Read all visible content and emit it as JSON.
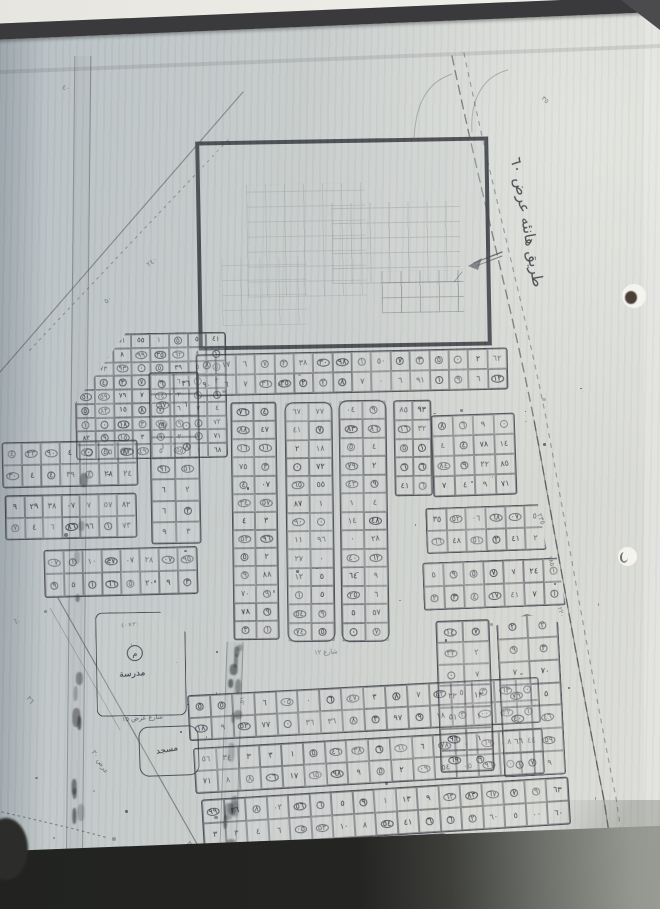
{
  "photo": {
    "paper_color": "#c6cbc9",
    "ink_color": "#3c3e46",
    "page_edge_bar_color": "#3a3a3c",
    "backing_top_color": "#efeee9",
    "backing_bottom_color": "#242523"
  },
  "labels": {
    "road_top_right": "طريق هانئه عرض ٦٠",
    "school": "مدرسة",
    "school_symbol": "م",
    "mosque": "مسجد",
    "street_south_of_school": "شارع عرض ١٥"
  },
  "map": {
    "glyph_pool": [
      "٠",
      "١",
      "٢",
      "٣",
      "٤",
      "٥",
      "٦",
      "٧",
      "٨",
      "٩"
    ],
    "blocks": [
      {
        "id": "triangle-block",
        "x": 75,
        "y": 333,
        "w": 152,
        "h": 126,
        "rows": 9,
        "cols": 8,
        "rot": -1,
        "r": 4,
        "clip": "polygon(34% 0, 100% 0, 100% 100%, 0 100%, 0 55%)"
      },
      {
        "id": "strip-under-rect",
        "x": 196,
        "y": 351,
        "w": 312,
        "h": 42,
        "rows": 2,
        "cols": 16,
        "rot": -1.3,
        "r": 3
      },
      {
        "id": "v-strip-1",
        "x": 232,
        "y": 402,
        "w": 46,
        "h": 238,
        "rows": 13,
        "cols": 2,
        "rot": -0.8,
        "r": 3
      },
      {
        "id": "v-strip-2",
        "x": 286,
        "y": 402,
        "w": 48,
        "h": 240,
        "rows": 13,
        "cols": 2,
        "rot": -0.8,
        "r": 9
      },
      {
        "id": "v-strip-3",
        "x": 340,
        "y": 400,
        "w": 48,
        "h": 242,
        "rows": 13,
        "cols": 2,
        "rot": -0.8,
        "r": 9
      },
      {
        "id": "v-strip-4",
        "x": 394,
        "y": 400,
        "w": 38,
        "h": 96,
        "rows": 5,
        "cols": 2,
        "rot": -1,
        "r": 3
      },
      {
        "id": "right-block-top",
        "x": 432,
        "y": 414,
        "w": 84,
        "h": 82,
        "rows": 4,
        "cols": 4,
        "rot": -2,
        "r": 3
      },
      {
        "id": "right-strip-1",
        "x": 426,
        "y": 506,
        "w": 120,
        "h": 46,
        "rows": 2,
        "cols": 6,
        "rot": -2,
        "r": 3,
        "clip": "polygon(0 0, 94% 0, 100% 100%, 0 100%)"
      },
      {
        "id": "right-strip-2",
        "x": 423,
        "y": 560,
        "w": 142,
        "h": 48,
        "rows": 2,
        "cols": 7,
        "rot": -2.2,
        "r": 3,
        "clip": "polygon(0 0, 95% 0, 100% 100%, 0 100%)"
      },
      {
        "id": "left-column",
        "x": 150,
        "y": 372,
        "w": 50,
        "h": 172,
        "rows": 8,
        "cols": 2,
        "rot": -1,
        "r": 3
      },
      {
        "id": "left-strip-1",
        "x": 2,
        "y": 441,
        "w": 136,
        "h": 46,
        "rows": 2,
        "cols": 7,
        "rot": -1.2,
        "r": 3
      },
      {
        "id": "left-strip-2",
        "x": 5,
        "y": 494,
        "w": 132,
        "h": 45,
        "rows": 2,
        "cols": 7,
        "rot": -1.2,
        "r": 3
      },
      {
        "id": "left-strip-3",
        "x": 44,
        "y": 548,
        "w": 154,
        "h": 48,
        "rows": 2,
        "cols": 8,
        "rot": -1.5,
        "r": 3
      },
      {
        "id": "bottom-strip-1",
        "x": 188,
        "y": 686,
        "w": 352,
        "h": 46,
        "rows": 2,
        "cols": 16,
        "rot": -3,
        "r": 3
      },
      {
        "id": "bottom-strip-2",
        "x": 194,
        "y": 738,
        "w": 350,
        "h": 46,
        "rows": 2,
        "cols": 16,
        "rot": -3.3,
        "r": 3
      },
      {
        "id": "bottom-strip-3",
        "x": 202,
        "y": 788,
        "w": 368,
        "h": 48,
        "rows": 2,
        "cols": 17,
        "rot": -3.6,
        "r": 3
      },
      {
        "id": "bottom-strip-4",
        "x": 188,
        "y": 840,
        "w": 260,
        "h": 56,
        "rows": 2,
        "cols": 11,
        "rot": -3,
        "r": 3
      },
      {
        "id": "bottom-right-low",
        "x": 452,
        "y": 846,
        "w": 168,
        "h": 58,
        "rows": 2,
        "cols": 8,
        "rot": -4,
        "r": 4
      },
      {
        "id": "bottom-v-strip-1",
        "x": 438,
        "y": 620,
        "w": 54,
        "h": 152,
        "rows": 7,
        "cols": 2,
        "rot": -2,
        "r": 3
      },
      {
        "id": "bottom-v-strip-2",
        "x": 500,
        "y": 614,
        "w": 62,
        "h": 162,
        "rows": 7,
        "cols": 2,
        "rot": -3,
        "r": 3,
        "clip": "polygon(0 6%, 50% 0, 100% 6%, 100% 100%, 0 100%)"
      }
    ],
    "notes": [
      {
        "t": "٢٣٥",
        "cx": 541,
        "cy": 519,
        "rot": 70,
        "s": 7,
        "o": 0.6
      },
      {
        "t": "١٨٥",
        "cx": 551,
        "cy": 561,
        "rot": 72,
        "s": 6.5,
        "o": 0.6
      },
      {
        "t": "٢٢٠",
        "cx": 561,
        "cy": 612,
        "rot": 74,
        "s": 6.5,
        "o": 0.55
      },
      {
        "t": "٢٤٠",
        "cx": 152,
        "cy": 262,
        "rot": -38,
        "s": 7,
        "o": 0.5
      },
      {
        "t": "٥٠",
        "cx": 108,
        "cy": 300,
        "rot": -38,
        "s": 7,
        "o": 0.5
      },
      {
        "t": "عرض ٢٠",
        "cx": 100,
        "cy": 762,
        "rot": 58,
        "s": 7,
        "o": 0.6
      },
      {
        "t": "٢٦",
        "cx": 30,
        "cy": 700,
        "rot": 55,
        "s": 7,
        "o": 0.55
      },
      {
        "t": "٤٠",
        "cx": 66,
        "cy": 88,
        "rot": 8,
        "s": 7,
        "o": 0.5
      },
      {
        "t": "٣٥",
        "cx": 545,
        "cy": 100,
        "rot": 40,
        "s": 7,
        "o": 0.5
      },
      {
        "t": "٢٤",
        "cx": 190,
        "cy": 845,
        "rot": 60,
        "s": 7,
        "o": 0.6
      },
      {
        "t": "٦٠",
        "cx": 17,
        "cy": 622,
        "rot": 0,
        "s": 7,
        "o": 0.5
      },
      {
        "t": "شارع ١٢",
        "cx": 326,
        "cy": 652,
        "rot": -3,
        "s": 6.5,
        "o": 0.55
      },
      {
        "t": "٣٠×٤٠",
        "cx": 130,
        "cy": 625,
        "rot": -6,
        "s": 6,
        "o": 0.5
      },
      {
        "t": "١٥",
        "cx": 242,
        "cy": 700,
        "rot": 80,
        "s": 6.5,
        "o": 0.5
      }
    ]
  }
}
